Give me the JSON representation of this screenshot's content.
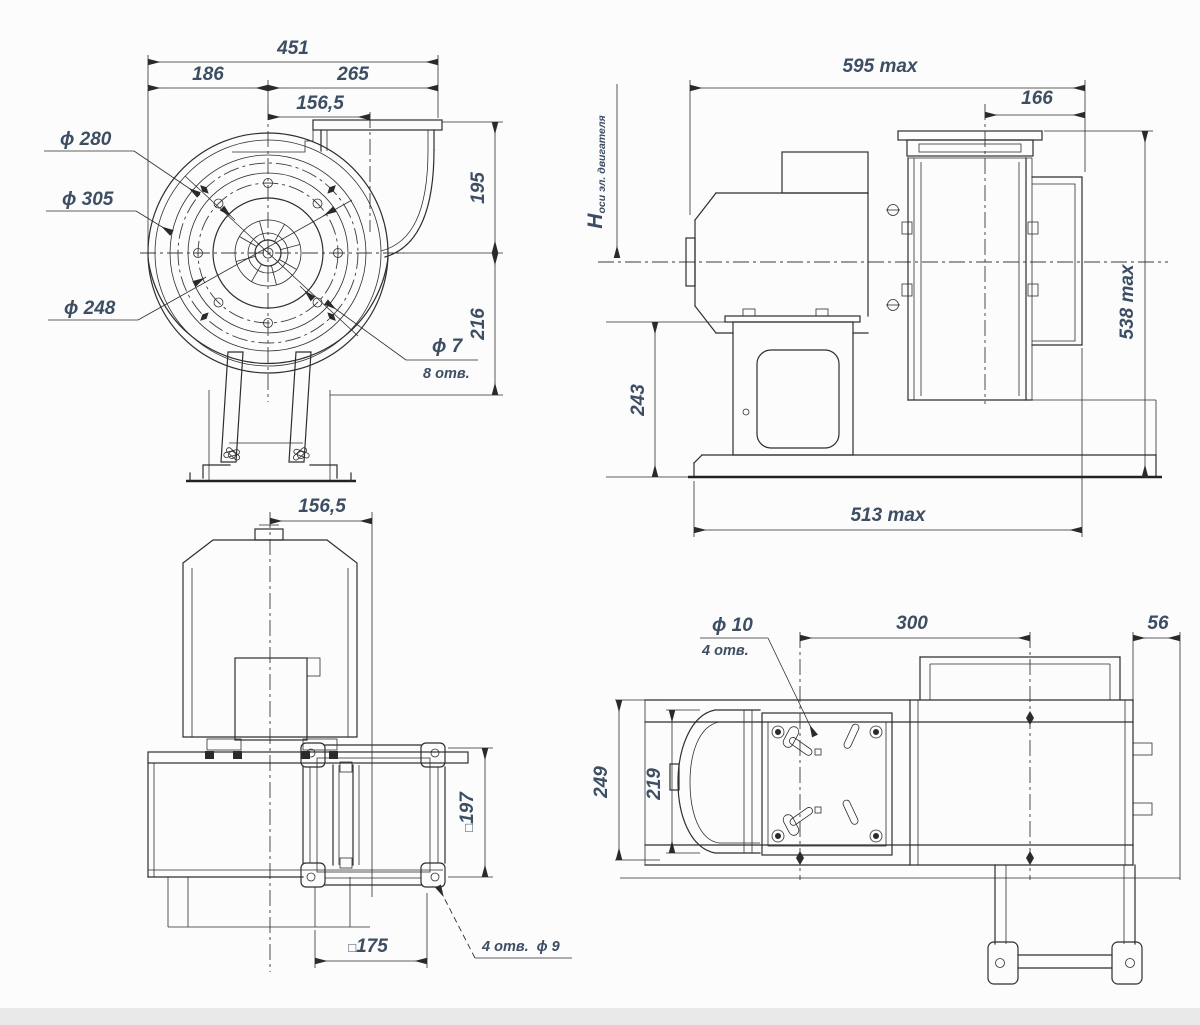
{
  "style": {
    "background": "#fcfcfc",
    "line_color": "#2e2e2e",
    "dim_text_color": "#3d4e63",
    "footer_strip": "#e9e9e9"
  },
  "front_view": {
    "total_width": "451",
    "left_width": "186",
    "right_width": "265",
    "outlet_offset": "156,5",
    "height_above_axis": "195",
    "height_below_axis": "216",
    "inlet_diameter": "ϕ 280",
    "flange_diameter": "ϕ 305",
    "bolt_circle_diameter": "ϕ 248",
    "hole_diameter": "ϕ 7",
    "hole_count": "8 отв."
  },
  "side_view": {
    "length_max": "595 max",
    "inlet_depth": "166",
    "axis_height_symbol": "H",
    "axis_height_label": "оси эл. двигателя",
    "pedestal_height": "243",
    "height_max": "538 max",
    "base_length_max": "513 max"
  },
  "top_view": {
    "outlet_offset": "156,5",
    "square_symbol": "□",
    "flange_size": "197",
    "outlet_size": "175",
    "holes_count": "4 отв.",
    "hole_diameter": "ϕ 9"
  },
  "plan_view": {
    "hole_diameter": "ϕ 10",
    "holes_count": "4 отв.",
    "bolt_spacing": "300",
    "inlet_offset": "56",
    "overall_width": "249",
    "motor_width": "219"
  }
}
